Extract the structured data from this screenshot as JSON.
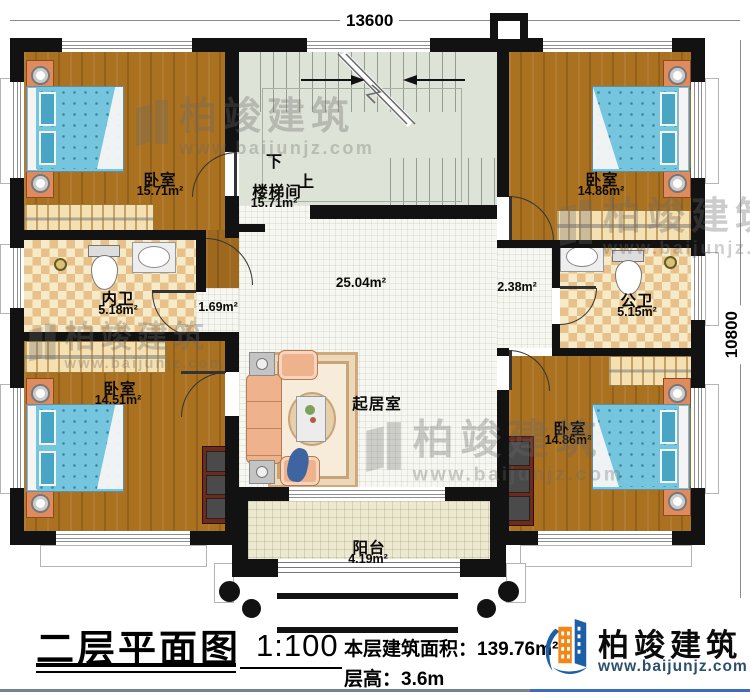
{
  "dimensions": {
    "top": "13600",
    "right": "10800"
  },
  "stairwell": {
    "name": "楼梯间",
    "area": "15.71m²",
    "down": "下",
    "up": "上"
  },
  "rooms": {
    "bedroom_tl": {
      "name": "卧室",
      "area": "15.71m²"
    },
    "bedroom_tr": {
      "name": "卧室",
      "area": "14.86m²"
    },
    "bedroom_bl": {
      "name": "卧室",
      "area": "14.51m²"
    },
    "bedroom_br": {
      "name": "卧室",
      "area": "14.86m²"
    },
    "bath_inner": {
      "name": "内卫",
      "area": "5.18m²"
    },
    "bath_public": {
      "name": "公卫",
      "area": "5.15m²"
    },
    "hall": {
      "area": "25.04m²"
    },
    "passage": {
      "area": "1.69m²"
    },
    "nook": {
      "area": "2.38m²"
    },
    "living": {
      "name": "起居室"
    },
    "balcony": {
      "name": "阳台",
      "area": "4.19m²"
    }
  },
  "title_block": {
    "title": "二层平面图",
    "scale": "1:100",
    "area_label": "本层建筑面积：",
    "area_value": "139.76m²",
    "height_label": "层高：",
    "height_value": "3.6m"
  },
  "brand": {
    "name": "柏竣建筑",
    "website": "www.baijunjz.com"
  },
  "watermark": {
    "name": "柏竣建筑",
    "website": "www.baijunjz.com"
  },
  "colors": {
    "wall": "#121212",
    "wood": "#aa7120",
    "bath_tile": "#e7c189",
    "stair_floor": "#dde3d6",
    "brand_blue": "#1d5fa6",
    "brand_orange": "#f28718"
  }
}
